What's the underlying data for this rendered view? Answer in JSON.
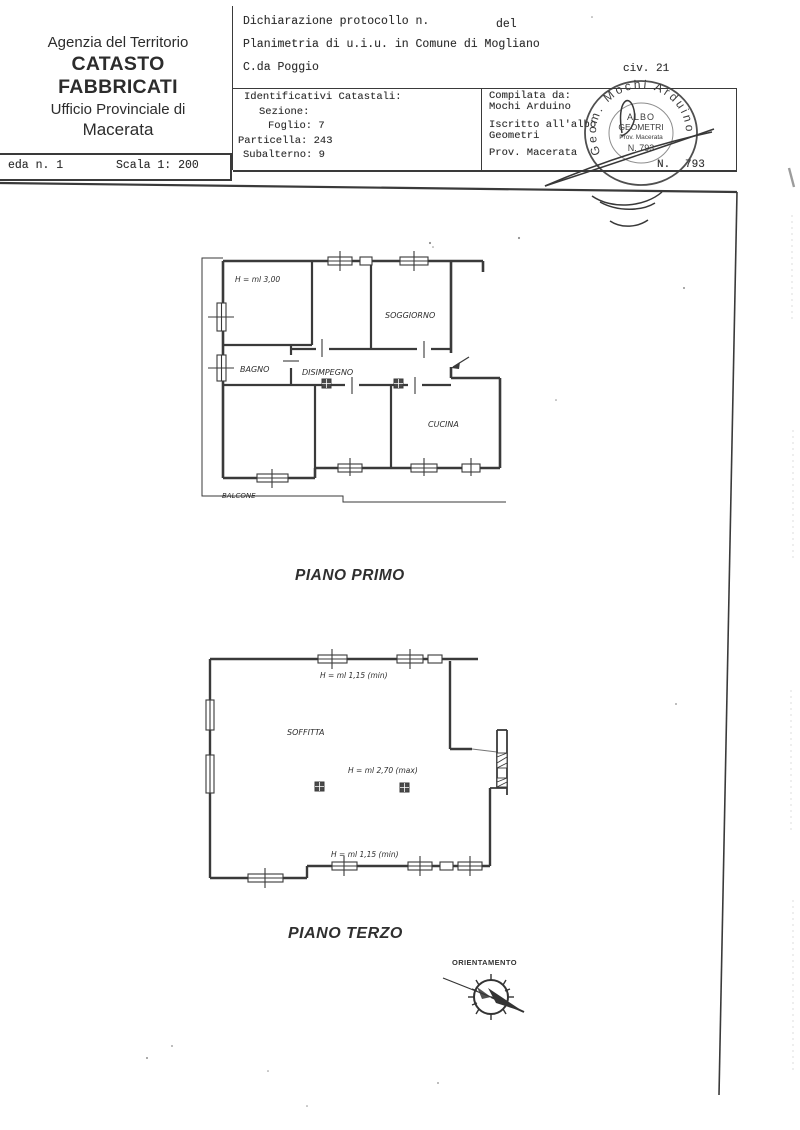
{
  "colors": {
    "ink": "#2e2e2e",
    "line": "#3a3a3a",
    "background": "#ffffff"
  },
  "agency": {
    "line1": "Agenzia del Territorio",
    "line2": "CATASTO FABBRICATI",
    "line3": "Ufficio Provinciale di",
    "line4": "Macerata"
  },
  "sheet": {
    "number": "eda n. 1",
    "scale": "Scala 1: 200"
  },
  "declaration": {
    "protocol": "Dichiarazione protocollo n.",
    "del": "del",
    "planimetria": "Planimetria di u.i.u. in Comune di Mogliano",
    "address": "C.da Poggio",
    "civ": "civ. 21"
  },
  "cadastral": {
    "title": "Identificativi Catastali:",
    "sezione": "Sezione:",
    "foglio": "Foglio: 7",
    "particella": "Particella: 243",
    "subalterno": "Subalterno: 9"
  },
  "compiler": {
    "compilata": "Compilata da:",
    "name": "Mochi Arduino",
    "iscritto": "Iscritto all'albo",
    "albo": "Geometri",
    "prov": "Prov. Macerata",
    "num_label": "N.",
    "num_value": "793"
  },
  "stamp": {
    "arc": "Geom. Mochi Arduino",
    "line1": "ALBO",
    "line2": "GEOMETRI",
    "line3": "Prov. Macerata",
    "line4": "N. 793"
  },
  "piano_primo": {
    "caption": "PIANO PRIMO",
    "height": "H = ml 3,00",
    "bagno": "BAGNO",
    "disimpegno": "DISIMPEGNO",
    "soggiorno": "SOGGIORNO",
    "cucina": "CUCINA",
    "balcone": "BALCONE"
  },
  "piano_terzo": {
    "caption": "PIANO TERZO",
    "soffitta": "SOFFITTA",
    "h_top": "H = ml 1,15 (min)",
    "h_mid": "H = ml 2,70 (max)",
    "h_bottom": "H = ml 1,15 (min)"
  },
  "compass": {
    "label": "ORIENTAMENTO"
  }
}
